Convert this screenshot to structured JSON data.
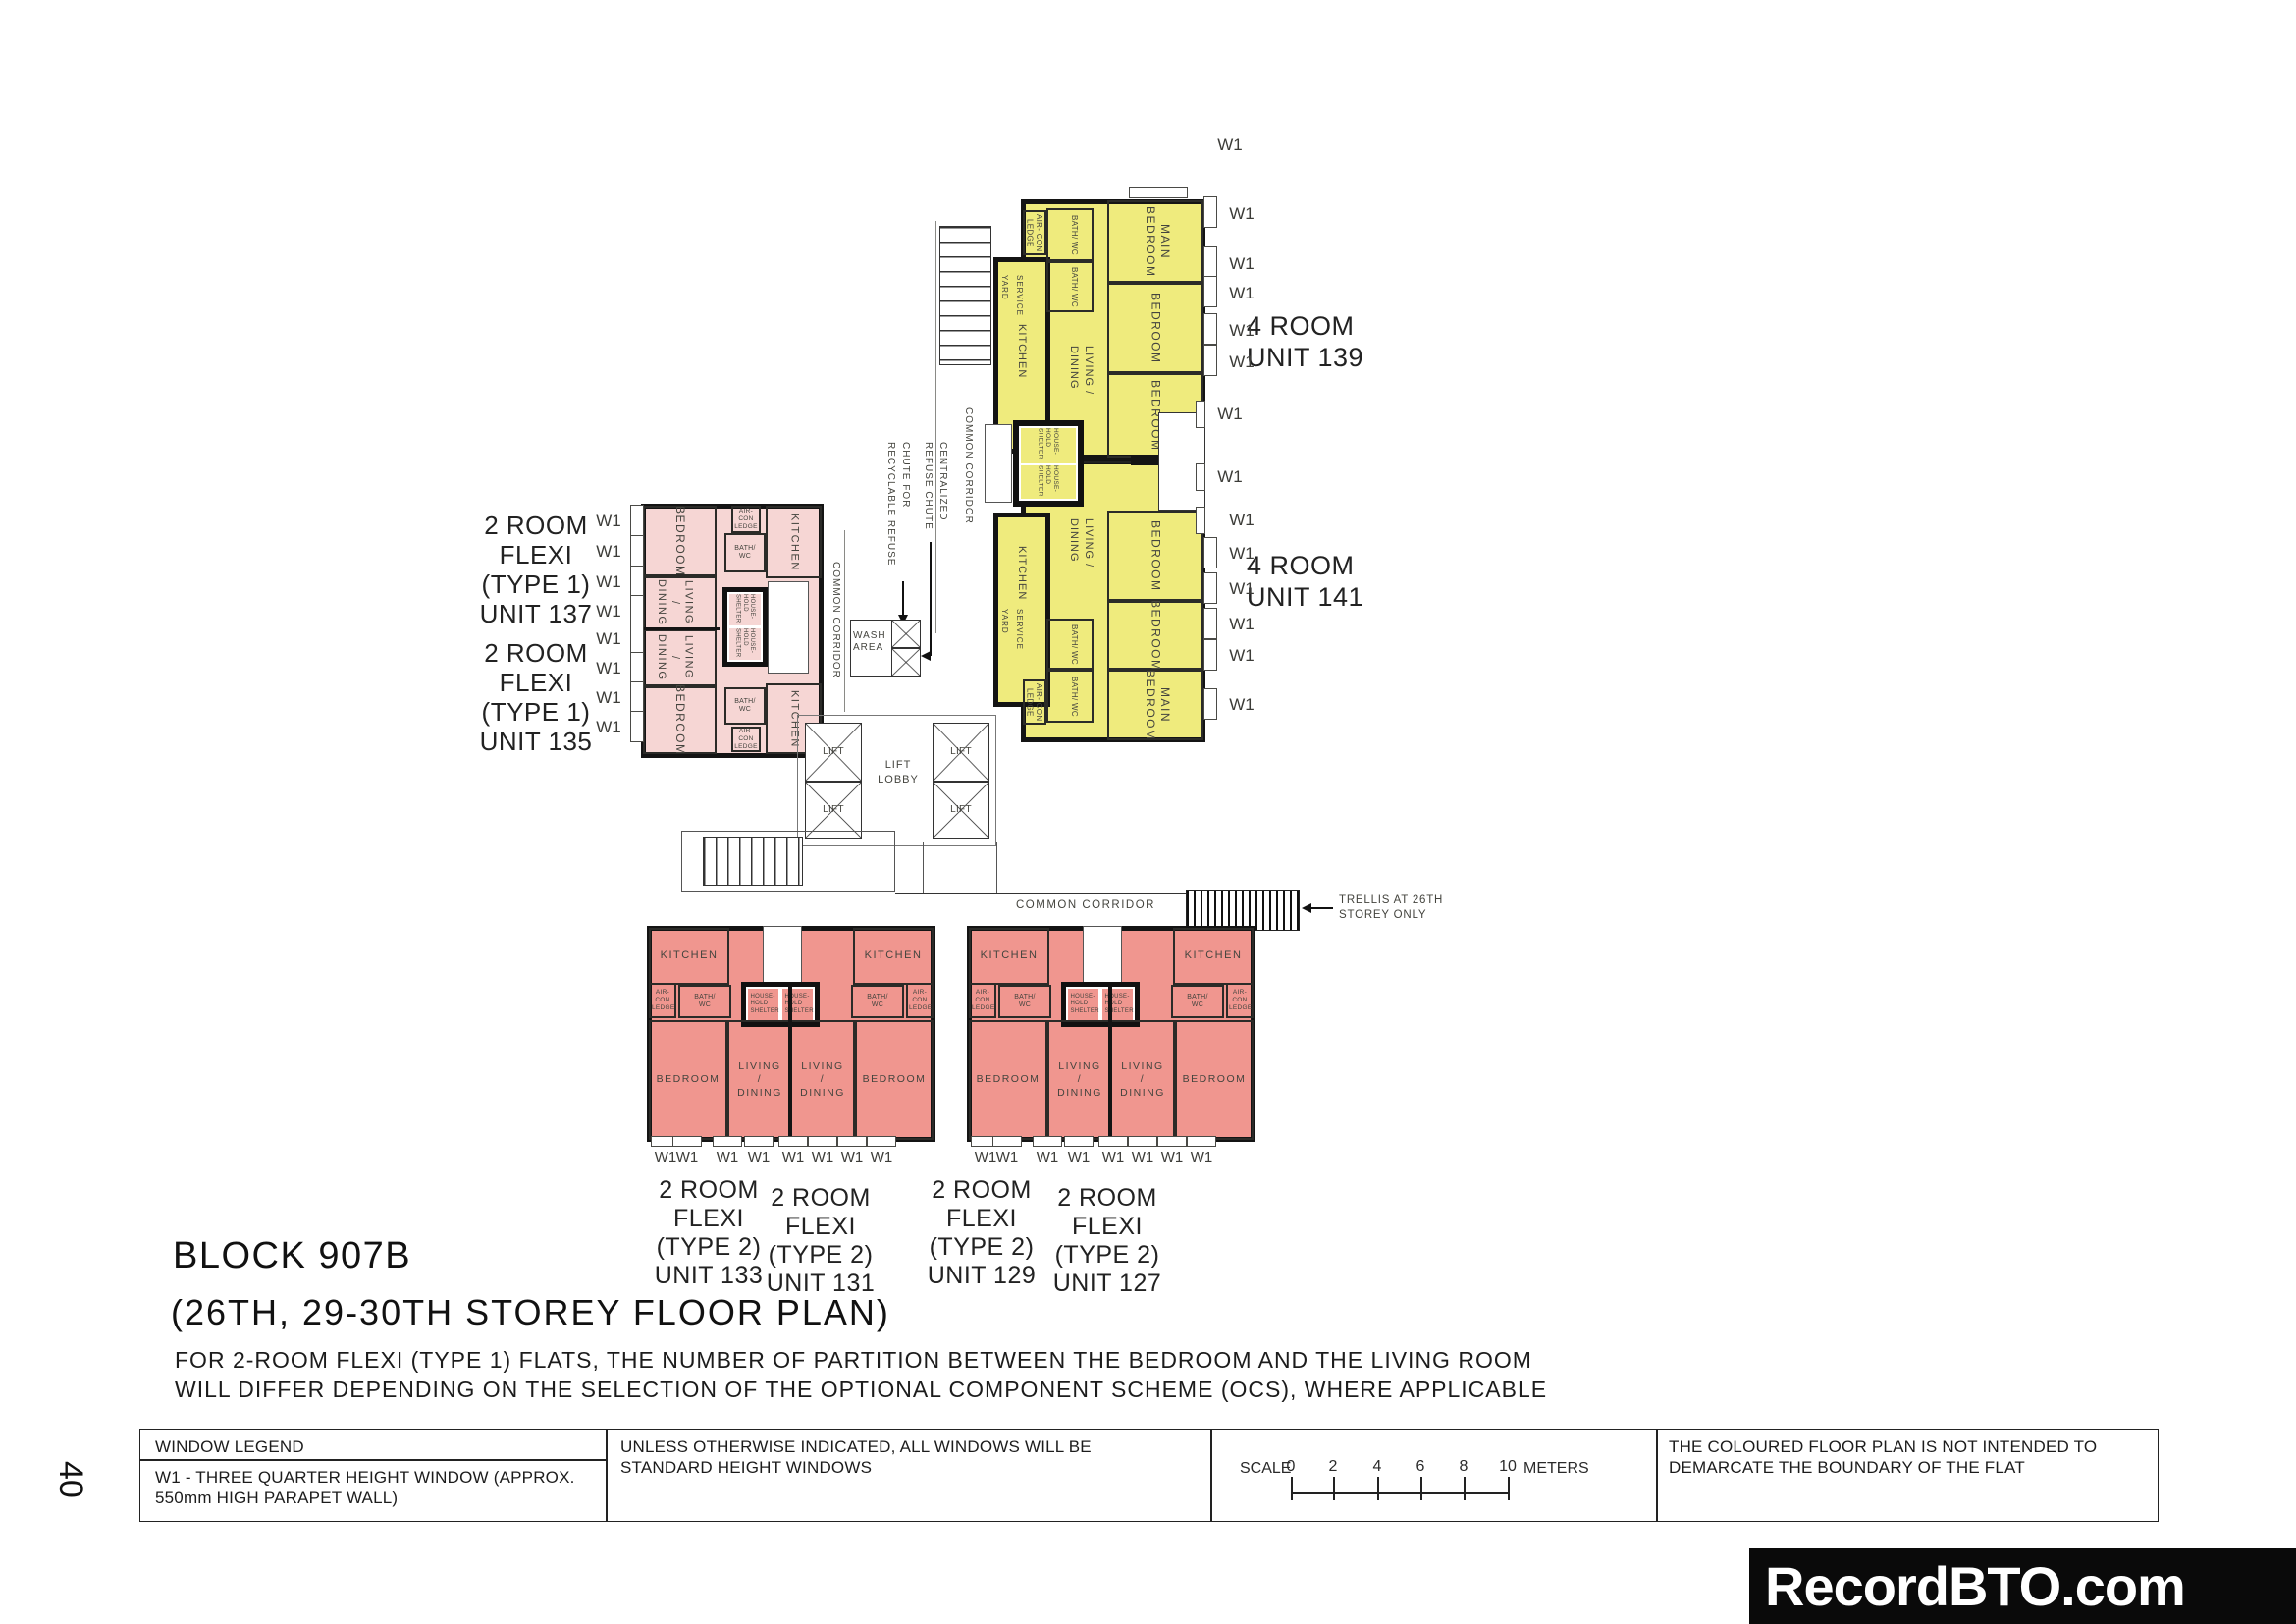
{
  "title": {
    "block": "BLOCK 907B",
    "storey": "(26TH, 29-30TH STOREY FLOOR PLAN)",
    "note1": "FOR 2-ROOM FLEXI (TYPE 1) FLATS, THE NUMBER OF PARTITION BETWEEN THE BEDROOM AND THE LIVING ROOM",
    "note2": "WILL DIFFER DEPENDING ON THE SELECTION OF THE OPTIONAL COMPONENT SCHEME (OCS), WHERE APPLICABLE"
  },
  "units": {
    "u139": {
      "type": "4 ROOM",
      "no": "UNIT 139"
    },
    "u141": {
      "type": "4 ROOM",
      "no": "UNIT 141"
    },
    "u137": {
      "l1": "2 ROOM",
      "l2": "FLEXI",
      "l3": "(TYPE 1)",
      "l4": "UNIT 137"
    },
    "u135": {
      "l1": "2 ROOM",
      "l2": "FLEXI",
      "l3": "(TYPE 1)",
      "l4": "UNIT 135"
    },
    "u133": {
      "l1": "2 ROOM",
      "l2": "FLEXI",
      "l3": "(TYPE 2)",
      "l4": "UNIT 133"
    },
    "u131": {
      "l1": "2 ROOM",
      "l2": "FLEXI",
      "l3": "(TYPE 2)",
      "l4": "UNIT 131"
    },
    "u129": {
      "l1": "2 ROOM",
      "l2": "FLEXI",
      "l3": "(TYPE 2)",
      "l4": "UNIT 129"
    },
    "u127": {
      "l1": "2 ROOM",
      "l2": "FLEXI",
      "l3": "(TYPE 2)",
      "l4": "UNIT 127"
    }
  },
  "rooms": {
    "kitchen": "KITCHEN",
    "bedroom": "BEDROOM",
    "main_bedroom": "MAIN BEDROOM",
    "living_dining": "LIVING / DINING",
    "household_shelter": "HOUSE- HOLD SHELTER",
    "bath_wc": "BATH/ WC",
    "aircon_ledge": "AIR- CON LEDGE",
    "service_yard": "SERVICE YARD",
    "wash_area": "WASH AREA",
    "lift": "LIFT",
    "lift_lobby": "LIFT LOBBY",
    "common_corridor": "COMMON CORRIDOR"
  },
  "annotations": {
    "w1": "W1",
    "centralized_chute": "CENTRALIZED REFUSE CHUTE",
    "recyclable_chute": "CHUTE FOR RECYCLABLE REFUSE",
    "trellis": "TRELLIS AT 26TH STOREY ONLY"
  },
  "legend": {
    "window_legend": "WINDOW LEGEND",
    "w1_desc": "W1 - THREE QUARTER HEIGHT WINDOW (APPROX. 550mm HIGH PARAPET WALL)",
    "standard_note": "UNLESS OTHERWISE INDICATED, ALL WINDOWS WILL BE STANDARD HEIGHT WINDOWS",
    "scale": "SCALE",
    "ticks": [
      "0",
      "2",
      "4",
      "6",
      "8",
      "10"
    ],
    "meters": "METERS",
    "coloured_note": "THE COLOURED FLOOR PLAN IS NOT INTENDED TO DEMARCATE THE BOUNDARY OF THE FLAT"
  },
  "footer": {
    "page": "40",
    "watermark": "RecordBTO.com"
  },
  "colors": {
    "four_room": "#EFEB7D",
    "two_room_type1": "#F6D6D4",
    "two_room_type2": "#F0968F"
  }
}
